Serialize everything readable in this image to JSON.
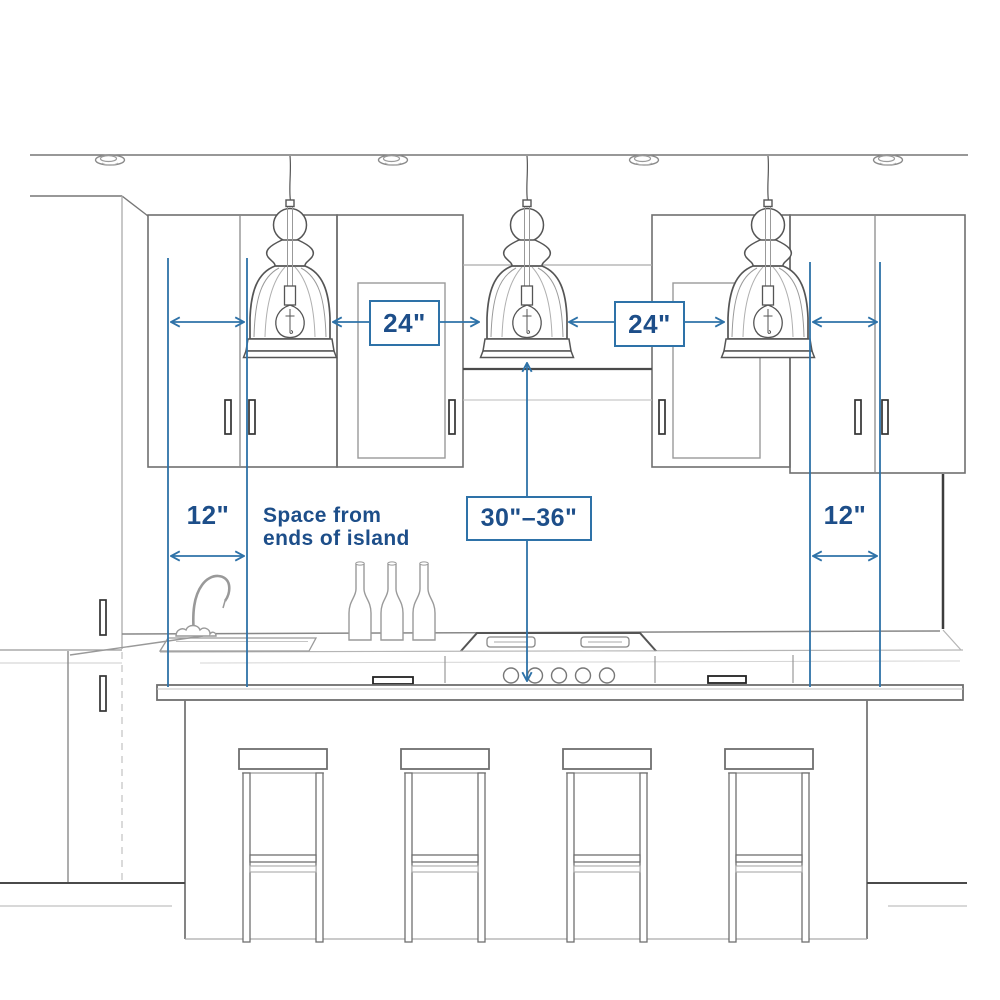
{
  "diagram": {
    "type": "kitchen-island-pendant-lighting-measurement-guide",
    "labels": {
      "pendant_gap_left": "24\"",
      "pendant_gap_right": "24\"",
      "height_above_counter": "30\"–36\"",
      "end_space_left": "12\"",
      "end_space_right": "12\"",
      "note_line1": "Space from",
      "note_line2": "ends of island"
    },
    "colors": {
      "dimension_line": "#2e72a8",
      "dimension_text": "#1d4e89",
      "box_border": "#2e72a8",
      "box_background": "#ffffff",
      "sketch_dark": "#4a4a4a",
      "sketch_main": "#6f6f6f",
      "sketch_light": "#a8a8a8",
      "background": "#ffffff"
    },
    "scene": {
      "pendant_count": 3,
      "recessed_light_count": 4,
      "stool_count": 4,
      "bottle_count": 3,
      "elements": [
        "ceiling",
        "recessed-lights",
        "pendant-lights",
        "upper-cabinets",
        "range-hood-recess",
        "faucet",
        "sink",
        "wine-bottles",
        "cooktop",
        "kitchen-island",
        "countertop",
        "bar-stools",
        "floor"
      ]
    }
  }
}
